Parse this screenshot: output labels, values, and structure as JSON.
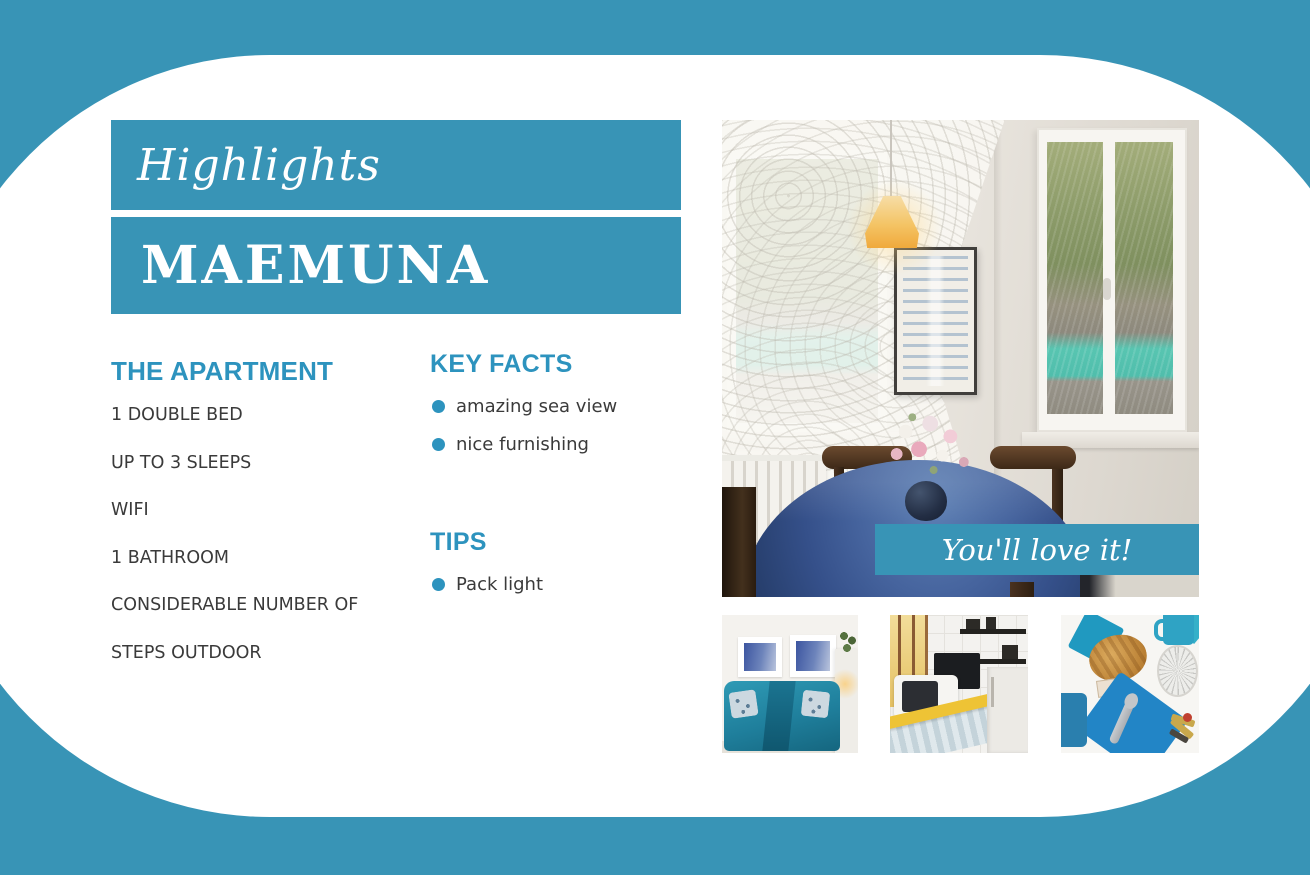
{
  "colors": {
    "accent_teal": "#3894b6",
    "heading_teal": "#2d93be",
    "body_text": "#3a3a3a",
    "card_white": "#ffffff"
  },
  "header": {
    "script_title": "Highlights",
    "property_name": "MAEMUNA"
  },
  "apartment": {
    "heading": "THE APARTMENT",
    "items": [
      "1 DOUBLE BED",
      "UP TO 3 SLEEPS",
      "WIFI",
      "1 BATHROOM",
      "CONSIDERABLE NUMBER OF STEPS OUTDOOR"
    ]
  },
  "key_facts": {
    "heading": "KEY FACTS",
    "items": [
      "amazing sea view",
      "nice furnishing"
    ]
  },
  "tips": {
    "heading": "TIPS",
    "items": [
      "Pack light"
    ]
  },
  "photo": {
    "caption": "You'll love it!"
  }
}
